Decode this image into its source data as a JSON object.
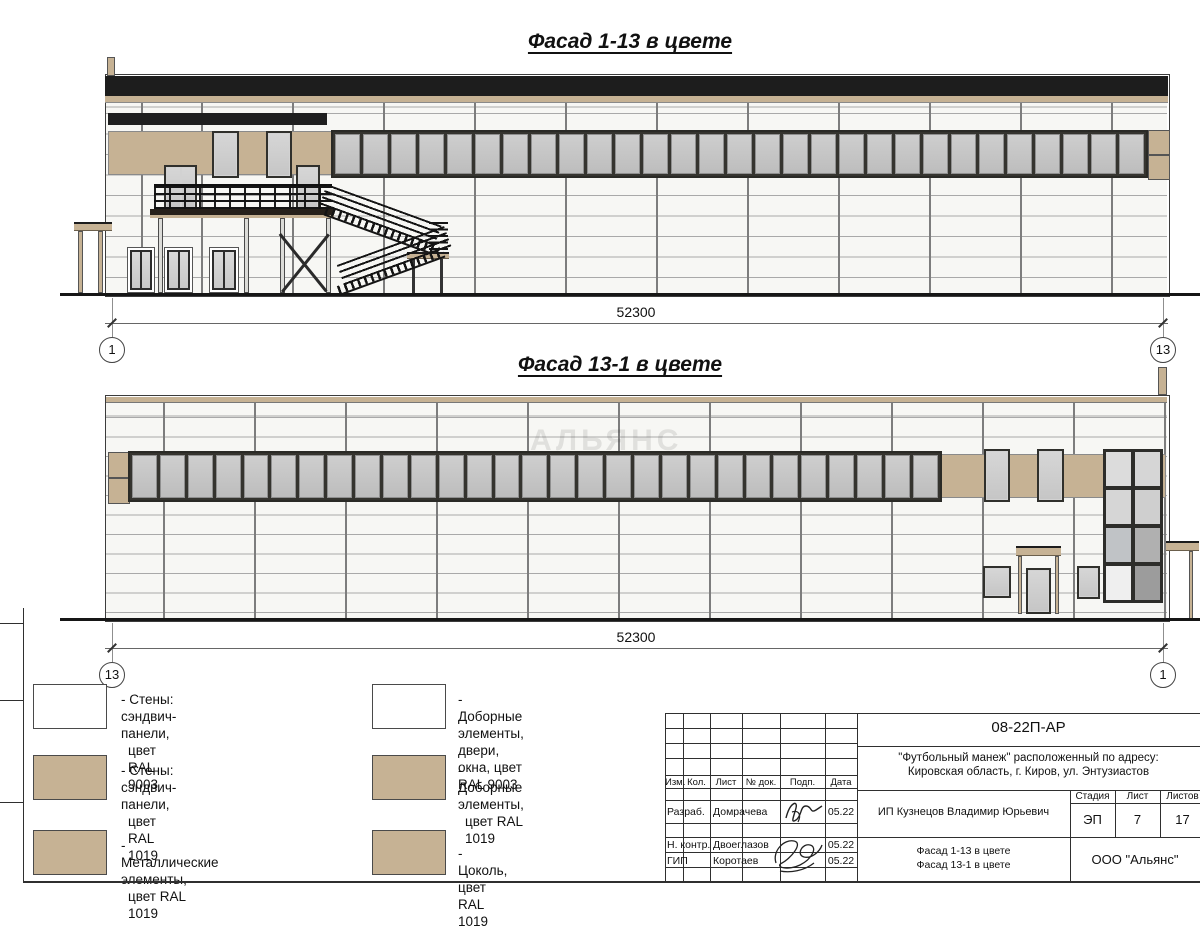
{
  "facades": [
    {
      "title": "Фасад 1-13 в цвете",
      "dimension": "52300",
      "axis_left": "1",
      "axis_right": "13",
      "ribbon_windows": 29
    },
    {
      "title": "Фасад 13-1 в цвете",
      "dimension": "52300",
      "axis_left": "13",
      "axis_right": "1",
      "ribbon_windows": 29
    }
  ],
  "watermark": "АЛЬЯНС",
  "legend": {
    "items": [
      {
        "swatch": "#ffffff",
        "line1": "- Стены: сэндвич-панели,",
        "line2": "цвет RAL 9003"
      },
      {
        "swatch": "#c6b294",
        "line1": "- Стены: сэндвич-панели,",
        "line2": "цвет RAL 1019"
      },
      {
        "swatch": "#c6b294",
        "line1": "- Металлические элементы,",
        "line2": "цвет RAL 1019"
      },
      {
        "swatch": "#ffffff",
        "line1": "- Доборные элементы, двери,",
        "line2": "окна, цвет RAL 9003"
      },
      {
        "swatch": "#c6b294",
        "line1": "- Доборные элементы,",
        "line2": "цвет RAL 1019"
      },
      {
        "swatch": "#c6b294",
        "line1": "- Цоколь, цвет RAL 1019",
        "line2": ""
      }
    ]
  },
  "title_block": {
    "doc_number": "08-22П-АР",
    "project_line1": "\"Футбольный манеж\" расположенный по адресу:",
    "project_line2": "Кировская область, г. Киров, ул. Энтузиастов",
    "columns": [
      "Изм.",
      "Кол.",
      "Лист",
      "№ док.",
      "Подп.",
      "Дата"
    ],
    "rows": [
      {
        "role": "Разраб.",
        "name": "Домрачева",
        "date": "05.22"
      },
      {
        "role": "Н. контр.",
        "name": "Двоеглазов",
        "date": "05.22"
      },
      {
        "role": "ГИП",
        "name": "Коротаев",
        "date": "05.22"
      }
    ],
    "client": "ИП Кузнецов Владимир Юрьевич",
    "stage_label": "Стадия",
    "sheet_label": "Лист",
    "sheets_label": "Листов",
    "stage": "ЭП",
    "sheet_no": "7",
    "sheets_total": "17",
    "drawing_title_line1": "Фасад 1-13 в цвете",
    "drawing_title_line2": "Фасад 13-1 в цвете",
    "company": "ООО \"Альянс\""
  },
  "colors": {
    "tan": "#c6b294",
    "roof": "#1d1d1d",
    "glass": "#c5c5c5",
    "frame": "#3a3a3a"
  }
}
